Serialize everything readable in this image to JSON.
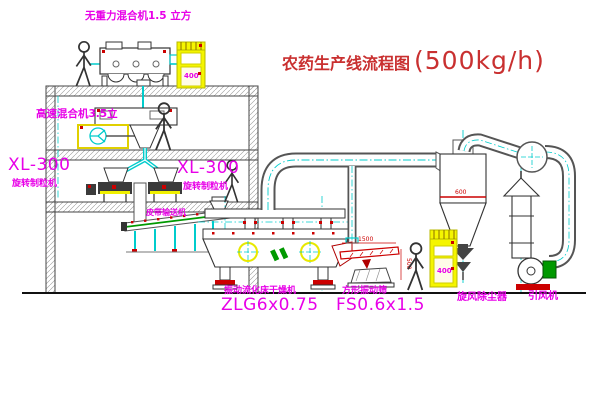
{
  "title": {
    "name": "农药生产线流程图",
    "capacity": "(500kg/h)"
  },
  "equipment_labels": {
    "gravity_mixer": "无重力混合机1.5 立方",
    "high_speed_mixer": "高速混合机3.5立",
    "granulator_left": {
      "model": "XL-300",
      "name": "旋转制粒机"
    },
    "granulator_right": {
      "model": "XL-300",
      "name": "旋转制粒机"
    },
    "belt_conveyor": "皮带输送机",
    "dryer": {
      "name": "振动流化床干燥机",
      "model": "ZLG6x0.75"
    },
    "sieve": {
      "name": "方形振动筛",
      "model": "FS0.6x1.5"
    },
    "cyclone": "旋风除尘器",
    "fan": "引风机"
  },
  "dimensions": {
    "sieve_length": "1500",
    "sieve_height": "500",
    "cyclone_band": "600"
  },
  "cabinet_marks": {
    "cabinet1": "400",
    "cabinet2": "400"
  },
  "colors": {
    "label_magenta": "#e800e8",
    "title_red": "#c93030",
    "centerline_cyan": "#00cccc",
    "cabinet_yellow": "#f5f500",
    "accent_red": "#cc0000",
    "accent_green": "#009900",
    "line_dark": "#333333"
  }
}
